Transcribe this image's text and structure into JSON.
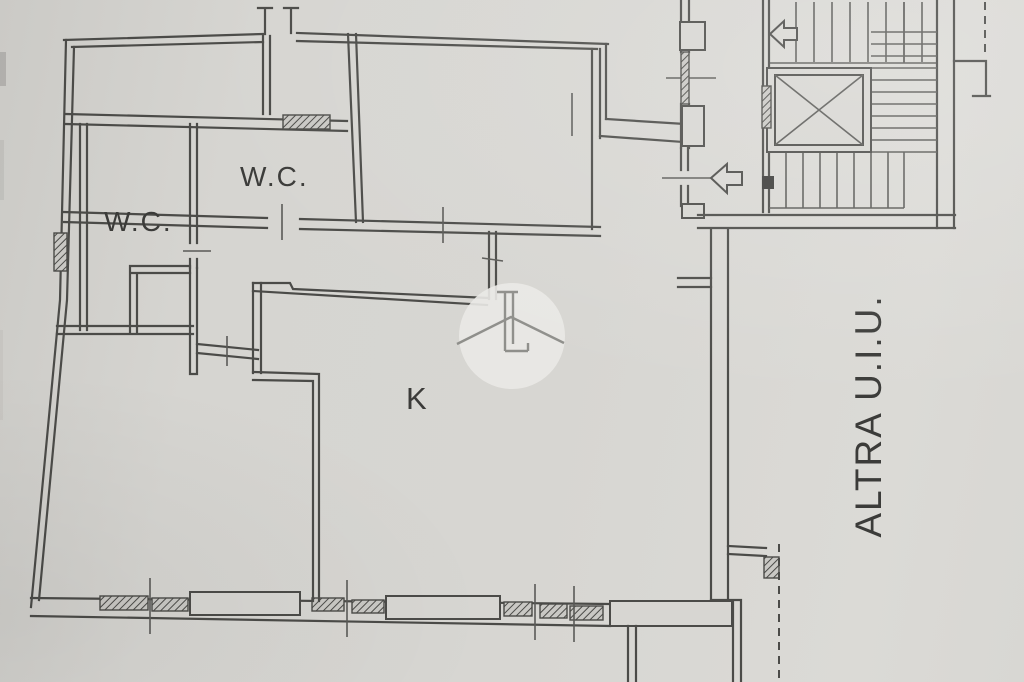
{
  "floor_plan": {
    "rooms": {
      "wc_left_label": "W.C.",
      "wc_top_label": "W.C.",
      "kitchen_label": "K",
      "adjacent_unit_label": "ALTRA U.I.U."
    },
    "icons": {
      "stairs_direction": "stairs-up-arrow",
      "entrance": "entrance-arrow",
      "elevator": "elevator-cross-box",
      "watermark": "house-watermark"
    },
    "colors": {
      "paper": "#d6d5d1",
      "ink": "#4b4b48",
      "watermark_disc": "#eae9e5",
      "label_ink": "#3b3b39"
    }
  }
}
